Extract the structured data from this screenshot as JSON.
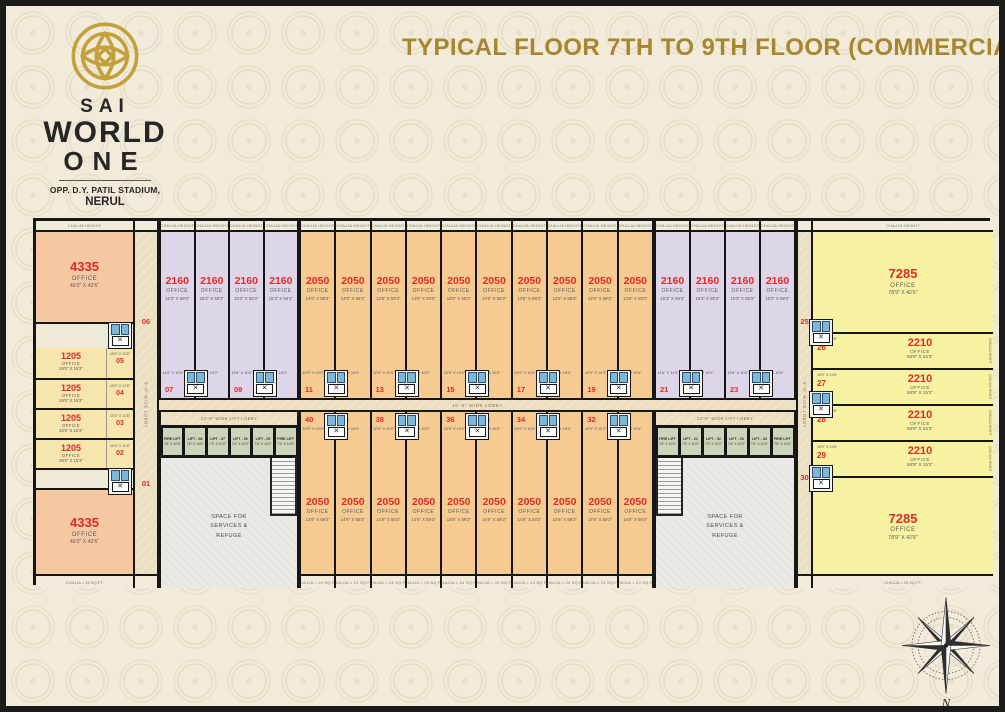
{
  "header": {
    "brand": {
      "line1": "SAI",
      "line2": "WORLD",
      "line3": "ONE",
      "address": "OPP. D.Y. PATIL STADIUM,",
      "city": "NERUL"
    },
    "title": "TYPICAL FLOOR 7TH TO 9TH FLOOR (COMMERCIAL)"
  },
  "icons": {
    "lift_x": "✕"
  },
  "colors": {
    "background": "#f2ebd9",
    "title_gold": "#a6862e",
    "logo_gold": "#c2a13d",
    "unit_number_red": "#df2b28",
    "lavender_unit": "#ded6e8",
    "orange_unit": "#f5cb92",
    "peach_unit": "#f6c8a2",
    "pale_yellow_unit": "#f6e6ad",
    "yellow_unit": "#f6f2a2",
    "lift_green": "#ccd5bb",
    "toilet_blue": "#7db7dc",
    "line_black": "#161616"
  },
  "plan": {
    "chajja_tag": "CHAJJA HEIGHT",
    "chajja_bottom_tag": "CHAJJA = 24 SQ.FT.",
    "lobbies": {
      "central": "10'-0\" WIDE LOBBY",
      "left_vertical": "8'-0\" WIDE LOBBY",
      "right_vertical": "8'-0\" WIDE LOBBY",
      "left_lift": "13'-6\" WIDE LIFT LOBBY",
      "right_lift": "13'-6\" WIDE LIFT LOBBY"
    },
    "services": {
      "l1": "SPACE FOR",
      "l2": "SERVICES &",
      "l3": "REFUGE"
    },
    "lifts_left": {
      "items": [
        "FIRE LIFT",
        "LIFT - 08",
        "LIFT - 07",
        "LIFT - 06",
        "LIFT - 05",
        "FIRE LIFT"
      ],
      "size": "7'6\" X 10'0\""
    },
    "lifts_right": {
      "items": [
        "FIRE LIFT",
        "LIFT - 01",
        "LIFT - 02",
        "LIFT - 03",
        "LIFT - 04",
        "FIRE LIFT"
      ],
      "size": "7'6\" X 10'0\""
    },
    "units": {
      "left": {
        "top4335": {
          "no": "06",
          "area": "4335",
          "type": "OFFICE",
          "dim": "46'0\" X 42'6\""
        },
        "bottom4335": {
          "no": "01",
          "area": "4335",
          "type": "OFFICE",
          "dim": "46'0\" X 42'6\""
        },
        "mid1205": [
          {
            "no": "05",
            "area": "1205",
            "type": "OFFICE",
            "dim": "28'0\" X 15'3\"",
            "wc": "10'0\" X 11'6\""
          },
          {
            "no": "04",
            "area": "1205",
            "type": "OFFICE",
            "dim": "28'0\" X 15'3\"",
            "wc": "10'0\" X 11'6\""
          },
          {
            "no": "03",
            "area": "1205",
            "type": "OFFICE",
            "dim": "28'0\" X 15'3\"",
            "wc": "10'0\" X 11'6\""
          },
          {
            "no": "02",
            "area": "1205",
            "type": "OFFICE",
            "dim": "28'0\" X 15'3\"",
            "wc": "10'0\" X 11'6\""
          }
        ]
      },
      "right": {
        "top7285": {
          "no": "25",
          "area": "7285",
          "type": "OFFICE",
          "dim": "78'9\" X 42'6\""
        },
        "bottom7285": {
          "no": "30",
          "area": "7285",
          "type": "OFFICE",
          "dim": "78'9\" X 42'6\""
        },
        "mid2210": [
          {
            "no": "26",
            "area": "2210",
            "type": "OFFICE",
            "dim": "60'9\" X 15'3\"",
            "wc": "10'0\" X 11'6\""
          },
          {
            "no": "27",
            "area": "2210",
            "type": "OFFICE",
            "dim": "60'9\" X 15'3\"",
            "wc": "10'0\" X 11'6\""
          },
          {
            "no": "28",
            "area": "2210",
            "type": "OFFICE",
            "dim": "60'9\" X 15'3\"",
            "wc": "10'0\" X 11'6\""
          },
          {
            "no": "29",
            "area": "2210",
            "type": "OFFICE",
            "dim": "60'9\" X 15'3\"",
            "wc": "10'0\" X 11'6\""
          }
        ]
      },
      "top": [
        {
          "no": "07",
          "area": "2160",
          "type": "OFFICE",
          "dim": "15'3\" X 59'3\"",
          "wc": "11'6\" X 10'0\"",
          "variant": "lavender",
          "toilet": "right"
        },
        {
          "no": "08",
          "area": "2160",
          "type": "OFFICE",
          "dim": "15'3\" X 59'3\"",
          "wc": "11'6\" X 10'0\"",
          "variant": "lavender"
        },
        {
          "no": "09",
          "area": "2160",
          "type": "OFFICE",
          "dim": "15'3\" X 59'3\"",
          "wc": "11'6\" X 10'0\"",
          "variant": "lavender",
          "toilet": "right"
        },
        {
          "no": "10",
          "area": "2160",
          "type": "OFFICE",
          "dim": "15'3\" X 59'3\"",
          "wc": "11'6\" X 10'0\"",
          "variant": "lavender"
        },
        {
          "no": "11",
          "area": "2050",
          "type": "OFFICE",
          "dim": "14'6\" X 59'3\"",
          "wc": "10'9\" X 10'0\"",
          "variant": "orange",
          "toilet": "right"
        },
        {
          "no": "12",
          "area": "2050",
          "type": "OFFICE",
          "dim": "14'6\" X 59'3\"",
          "wc": "10'9\" X 10'0\"",
          "variant": "orange"
        },
        {
          "no": "13",
          "area": "2050",
          "type": "OFFICE",
          "dim": "14'6\" X 59'3\"",
          "wc": "10'9\" X 10'0\"",
          "variant": "orange",
          "toilet": "right"
        },
        {
          "no": "14",
          "area": "2050",
          "type": "OFFICE",
          "dim": "14'6\" X 59'3\"",
          "wc": "10'9\" X 10'0\"",
          "variant": "orange"
        },
        {
          "no": "15",
          "area": "2050",
          "type": "OFFICE",
          "dim": "14'6\" X 59'3\"",
          "wc": "10'9\" X 10'0\"",
          "variant": "orange",
          "toilet": "right"
        },
        {
          "no": "16",
          "area": "2050",
          "type": "OFFICE",
          "dim": "14'6\" X 59'3\"",
          "wc": "10'9\" X 10'0\"",
          "variant": "orange"
        },
        {
          "no": "17",
          "area": "2050",
          "type": "OFFICE",
          "dim": "14'6\" X 59'3\"",
          "wc": "10'9\" X 10'0\"",
          "variant": "orange",
          "toilet": "right"
        },
        {
          "no": "18",
          "area": "2050",
          "type": "OFFICE",
          "dim": "14'6\" X 59'3\"",
          "wc": "10'9\" X 10'0\"",
          "variant": "orange"
        },
        {
          "no": "19",
          "area": "2050",
          "type": "OFFICE",
          "dim": "14'6\" X 59'3\"",
          "wc": "10'9\" X 10'0\"",
          "variant": "orange",
          "toilet": "right"
        },
        {
          "no": "20",
          "area": "2050",
          "type": "OFFICE",
          "dim": "14'6\" X 59'3\"",
          "wc": "10'9\" X 10'0\"",
          "variant": "orange"
        },
        {
          "no": "21",
          "area": "2160",
          "type": "OFFICE",
          "dim": "15'3\" X 59'3\"",
          "wc": "11'6\" X 10'0\"",
          "variant": "lavender",
          "toilet": "right"
        },
        {
          "no": "22",
          "area": "2160",
          "type": "OFFICE",
          "dim": "15'3\" X 59'3\"",
          "wc": "11'6\" X 10'0\"",
          "variant": "lavender"
        },
        {
          "no": "23",
          "area": "2160",
          "type": "OFFICE",
          "dim": "15'3\" X 59'3\"",
          "wc": "11'6\" X 10'0\"",
          "variant": "lavender",
          "toilet": "right"
        },
        {
          "no": "24",
          "area": "2160",
          "type": "OFFICE",
          "dim": "15'3\" X 59'3\"",
          "wc": "11'6\" X 10'0\"",
          "variant": "lavender"
        }
      ],
      "bottom": [
        {
          "no": "40",
          "area": "2050",
          "type": "OFFICE",
          "dim": "14'6\" X 59'3\"",
          "wc": "10'9\" X 10'0\"",
          "variant": "orange",
          "toilet": "right"
        },
        {
          "no": "39",
          "area": "2050",
          "type": "OFFICE",
          "dim": "14'6\" X 59'3\"",
          "wc": "10'9\" X 10'0\"",
          "variant": "orange"
        },
        {
          "no": "38",
          "area": "2050",
          "type": "OFFICE",
          "dim": "14'6\" X 59'3\"",
          "wc": "10'9\" X 10'0\"",
          "variant": "orange",
          "toilet": "right"
        },
        {
          "no": "37",
          "area": "2050",
          "type": "OFFICE",
          "dim": "14'6\" X 59'3\"",
          "wc": "10'9\" X 10'0\"",
          "variant": "orange"
        },
        {
          "no": "36",
          "area": "2050",
          "type": "OFFICE",
          "dim": "14'6\" X 59'3\"",
          "wc": "10'9\" X 10'0\"",
          "variant": "orange",
          "toilet": "right"
        },
        {
          "no": "35",
          "area": "2050",
          "type": "OFFICE",
          "dim": "14'6\" X 59'3\"",
          "wc": "10'9\" X 10'0\"",
          "variant": "orange"
        },
        {
          "no": "34",
          "area": "2050",
          "type": "OFFICE",
          "dim": "14'6\" X 59'3\"",
          "wc": "10'9\" X 10'0\"",
          "variant": "orange",
          "toilet": "right"
        },
        {
          "no": "33",
          "area": "2050",
          "type": "OFFICE",
          "dim": "14'6\" X 59'3\"",
          "wc": "10'9\" X 10'0\"",
          "variant": "orange"
        },
        {
          "no": "32",
          "area": "2050",
          "type": "OFFICE",
          "dim": "14'6\" X 59'3\"",
          "wc": "10'9\" X 10'0\"",
          "variant": "orange",
          "toilet": "right"
        },
        {
          "no": "31",
          "area": "2050",
          "type": "OFFICE",
          "dim": "14'6\" X 59'3\"",
          "wc": "10'9\" X 10'0\"",
          "variant": "orange"
        }
      ]
    }
  },
  "compass": {
    "label": "N"
  }
}
